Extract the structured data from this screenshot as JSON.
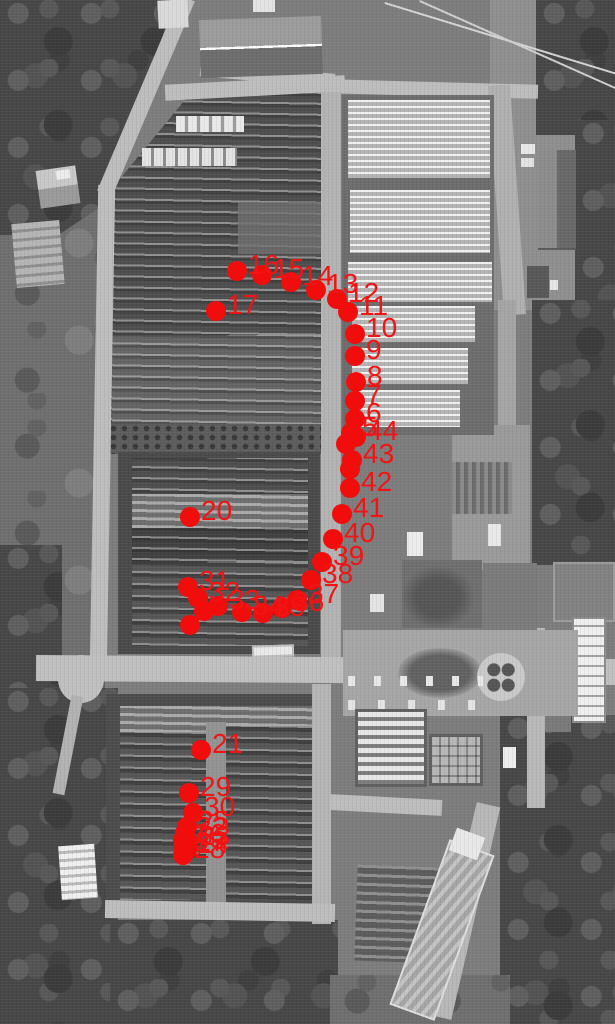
{
  "scene": {
    "type": "aerial-photo-with-waypoints",
    "marker_color": "#f20d0d",
    "label_color": "#f21414"
  },
  "markers": [
    {
      "label": "5",
      "x": 351,
      "y": 433
    },
    {
      "label": "6",
      "x": 355,
      "y": 419
    },
    {
      "label": "7",
      "x": 355,
      "y": 401
    },
    {
      "label": "8",
      "x": 356,
      "y": 382
    },
    {
      "label": "9",
      "x": 355,
      "y": 356
    },
    {
      "label": "10",
      "x": 355,
      "y": 334
    },
    {
      "label": "11",
      "x": 348,
      "y": 312
    },
    {
      "label": "12",
      "x": 337,
      "y": 299
    },
    {
      "label": "13",
      "x": 316,
      "y": 290
    },
    {
      "label": "14",
      "x": 291,
      "y": 282
    },
    {
      "label": "15",
      "x": 262,
      "y": 275
    },
    {
      "label": "16",
      "x": 237,
      "y": 271
    },
    {
      "label": "17",
      "x": 216,
      "y": 311
    },
    {
      "label": "20",
      "x": 190,
      "y": 517
    },
    {
      "label": "21",
      "x": 201,
      "y": 750
    },
    {
      "label": "22",
      "x": 185,
      "y": 833
    },
    {
      "label": "23",
      "x": 188,
      "y": 842
    },
    {
      "label": "24",
      "x": 187,
      "y": 850
    },
    {
      "label": "25",
      "x": 187,
      "y": 827
    },
    {
      "label": "26",
      "x": 183,
      "y": 840
    },
    {
      "label": "27",
      "x": 184,
      "y": 848
    },
    {
      "label": "28",
      "x": 183,
      "y": 855
    },
    {
      "label": "29",
      "x": 189,
      "y": 793
    },
    {
      "label": "30",
      "x": 193,
      "y": 813
    },
    {
      "label": "31",
      "x": 188,
      "y": 587
    },
    {
      "label": "32",
      "x": 198,
      "y": 598
    },
    {
      "label": "33",
      "x": 218,
      "y": 606
    },
    {
      "label": "34",
      "x": 242,
      "y": 612
    },
    {
      "label": "35",
      "x": 263,
      "y": 613
    },
    {
      "label": "36",
      "x": 282,
      "y": 608
    },
    {
      "label": "37",
      "x": 297,
      "y": 600
    },
    {
      "label": "38",
      "x": 311,
      "y": 580
    },
    {
      "label": "39",
      "x": 322,
      "y": 562
    },
    {
      "label": "40",
      "x": 333,
      "y": 539
    },
    {
      "label": "41",
      "x": 342,
      "y": 514
    },
    {
      "label": "42",
      "x": 350,
      "y": 488
    },
    {
      "label": "43",
      "x": 352,
      "y": 460
    },
    {
      "label": "44",
      "x": 356,
      "y": 437
    },
    {
      "label": "",
      "x": 204,
      "y": 611
    },
    {
      "label": "",
      "x": 190,
      "y": 625
    },
    {
      "label": "",
      "x": 346,
      "y": 444
    },
    {
      "label": "",
      "x": 350,
      "y": 469
    }
  ]
}
